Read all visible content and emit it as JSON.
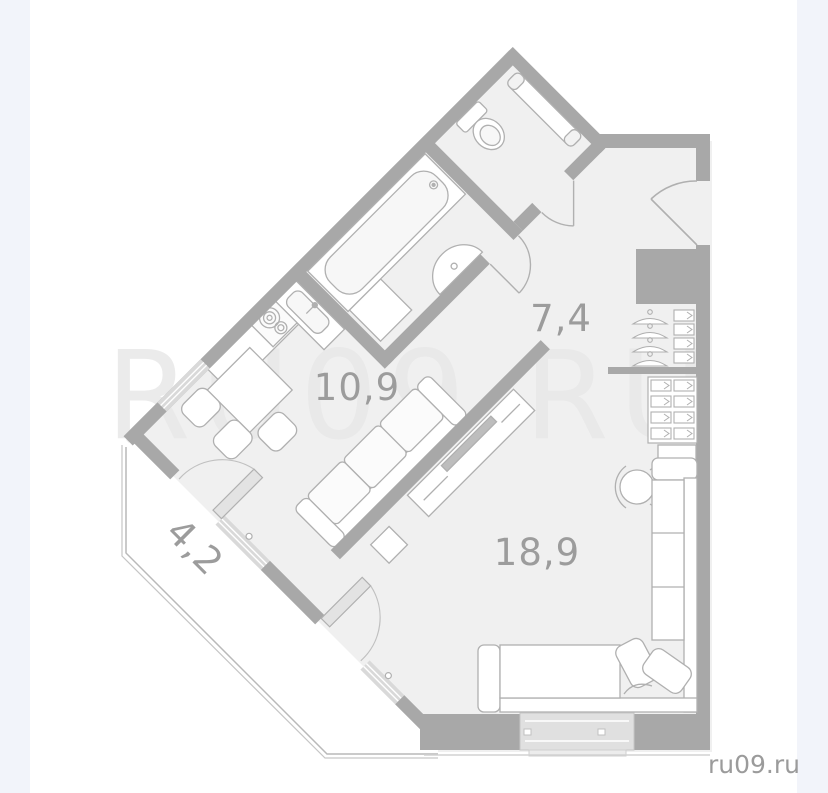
{
  "plan": {
    "watermark": "RU09.RU",
    "logo": "ru09.ru",
    "rooms": [
      {
        "id": "hallway",
        "area_label": "7,4"
      },
      {
        "id": "kitchen",
        "area_label": "10,9"
      },
      {
        "id": "living-room",
        "area_label": "18,9"
      },
      {
        "id": "balcony",
        "area_label": "4,2"
      }
    ],
    "colors": {
      "wall": "#a8a8a8",
      "floor": "#f0f0f0",
      "furniture_line": "#b0b0b0",
      "window_glass": "#d9d9d9",
      "side_strip": "#f2f4fa",
      "label_text": "#9c9c9c",
      "watermark_text": "#e8e8e8",
      "logo_text": "#9b9b9b"
    }
  }
}
